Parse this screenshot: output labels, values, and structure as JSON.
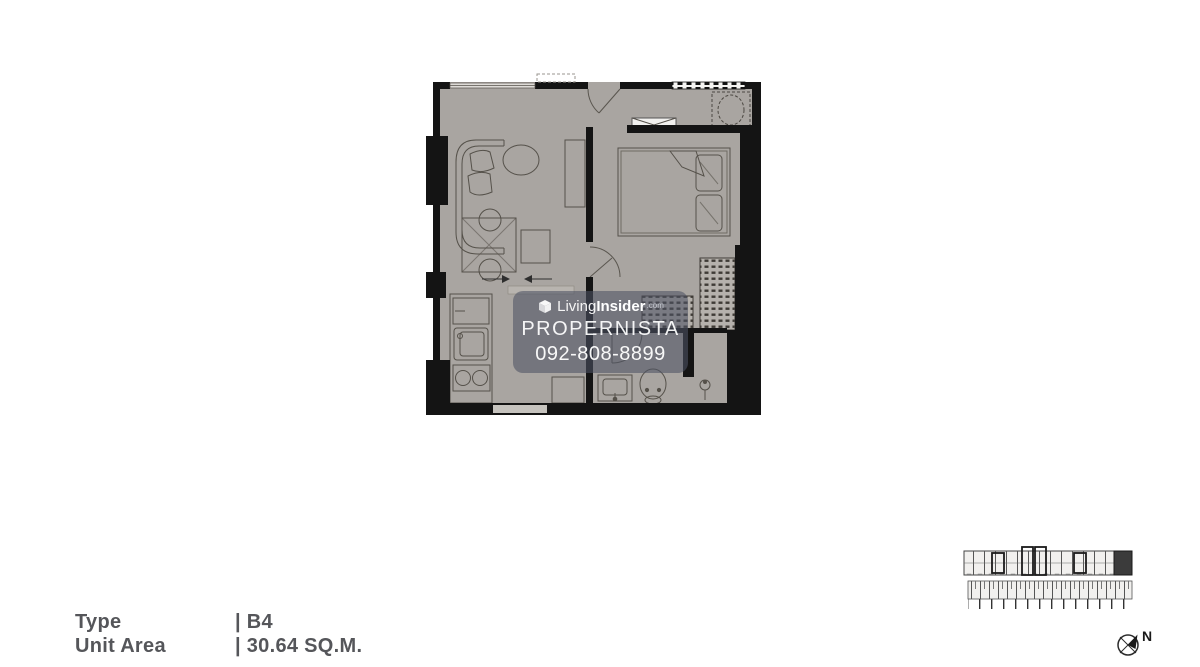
{
  "watermark": {
    "brand_light": "Living",
    "brand_bold": "Insider",
    "brand_suffix": ".com",
    "agency": "PROPERNISTA",
    "phone": "092-808-8899"
  },
  "legend": {
    "rows": [
      {
        "label": "Type",
        "value": "| B4"
      },
      {
        "label": "Unit Area",
        "value": "| 30.64 SQ.M."
      }
    ]
  },
  "compass": {
    "label": "N"
  },
  "floorplan": {
    "unit_type": "B4",
    "unit_area_sqm": 30.64
  },
  "colors": {
    "background": "#ffffff",
    "floor": "#a9a5a1",
    "wall": "#141414",
    "furniture_line": "#55514a",
    "legend_text": "#55565a",
    "watermark_bg": "rgba(78,82,100,0.58)",
    "watermark_text": "#ffffff",
    "keyplan_highlight": "#3b3b3b"
  }
}
